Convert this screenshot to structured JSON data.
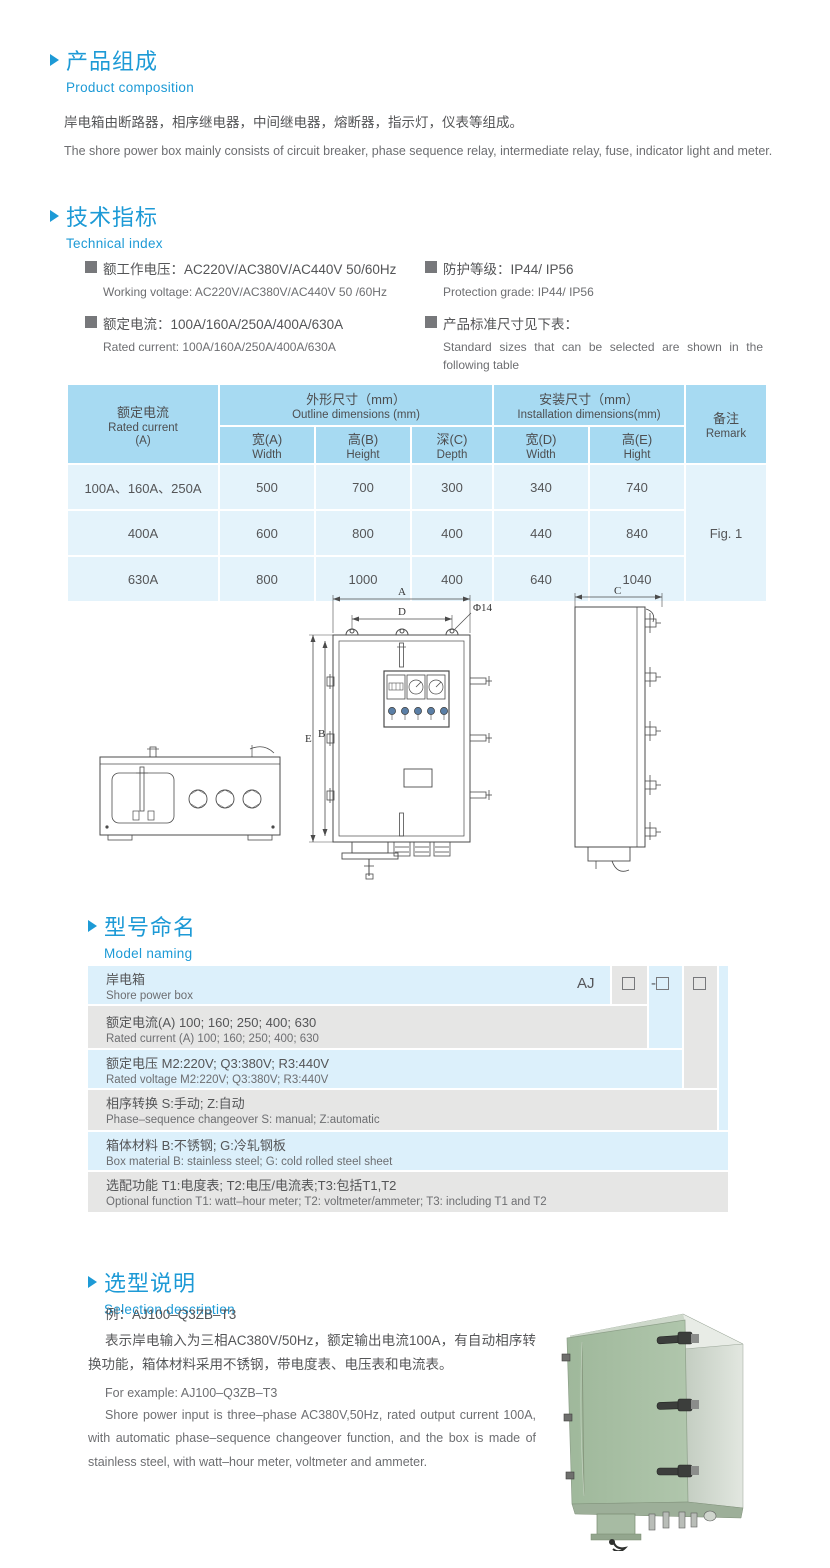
{
  "palette": {
    "accent_blue": "#1d9ad6",
    "table_header_blue": "#a7daf2",
    "table_cell_blue": "#e4f3fb",
    "naming_blue": "#dcf0fb",
    "naming_gray": "#e6e6e5",
    "photo_front_green": "#a9c0a5",
    "photo_side_gray": "#d6dcd4"
  },
  "section1": {
    "title_cn": "产品组成",
    "title_en": "Product  composition",
    "body_cn": "岸电箱由断路器，相序继电器，中间继电器，熔断器，指示灯，仪表等组成。",
    "body_en": "The shore power box mainly consists of circuit breaker, phase sequence relay, intermediate relay, fuse, indicator light and meter."
  },
  "section2": {
    "title_cn": "技术指标",
    "title_en": "Technical index",
    "specs": [
      {
        "cn": "额工作电压：AC220V/AC380V/AC440V  50/60Hz",
        "en": "Working voltage: AC220V/AC380V/AC440V 50 /60Hz"
      },
      {
        "cn": "额定电流：100A/160A/250A/400A/630A",
        "en": "Rated current: 100A/160A/250A/400A/630A"
      },
      {
        "cn": "防护等级：IP44/ IP56",
        "en": "Protection grade: IP44/ IP56"
      },
      {
        "cn": "产品标准尺寸见下表：",
        "en": "Standard sizes that can be selected are shown in the following table"
      }
    ]
  },
  "dim_table": {
    "col_current_cn": "额定电流",
    "col_current_en": "Rated current",
    "col_current_unit": "(A)",
    "outline_cn": "外形尺寸（mm）",
    "outline_en": "Outline dimensions (mm)",
    "install_cn": "安装尺寸（mm）",
    "install_en": "Installation dimensions(mm)",
    "remark_cn": "备注",
    "remark_en": "Remark",
    "sub_headers": [
      {
        "cn": "宽(A)",
        "en": "Width"
      },
      {
        "cn": "高(B)",
        "en": "Height"
      },
      {
        "cn": "深(C)",
        "en": "Depth"
      },
      {
        "cn": "宽(D)",
        "en": "Width"
      },
      {
        "cn": "高(E)",
        "en": "Hight"
      }
    ],
    "rows": [
      {
        "current": "100A、160A、250A",
        "a": "500",
        "b": "700",
        "c": "300",
        "d": "340",
        "e": "740"
      },
      {
        "current": "400A",
        "a": "600",
        "b": "800",
        "c": "400",
        "d": "440",
        "e": "840"
      },
      {
        "current": "630A",
        "a": "800",
        "b": "1000",
        "c": "400",
        "d": "640",
        "e": "1040"
      }
    ],
    "remark_value": "Fig. 1"
  },
  "drawing_labels": {
    "a": "A",
    "b": "B",
    "c": "C",
    "d": "D",
    "e": "E",
    "phi": "Φ14"
  },
  "section3": {
    "title_cn": "型号命名",
    "title_en": "Model naming",
    "code_prefix": "AJ",
    "code_dash": "-",
    "rows": [
      {
        "cn": "岸电箱",
        "en": "Shore power box"
      },
      {
        "cn": "额定电流(A)  100; 160; 250; 400; 630",
        "en": "Rated current (A) 100; 160; 250; 400; 630"
      },
      {
        "cn": "额定电压   M2:220V;  Q3:380V;  R3:440V",
        "en": "Rated voltage  M2:220V;  Q3:380V;  R3:440V"
      },
      {
        "cn": "相序转换  S:手动; Z:自动",
        "en": "Phase–sequence changeover  S: manual;  Z:automatic"
      },
      {
        "cn": "箱体材料    B:不锈钢;  G:冷轧钢板",
        "en": "Box material   B: stainless steel; G: cold rolled steel sheet"
      },
      {
        "cn": "选配功能     T1:电度表;  T2:电压/电流表;T3:包括T1,T2",
        "en": "Optional function  T1: watt–hour meter; T2: voltmeter/ammeter; T3: including T1 and T2"
      }
    ]
  },
  "section4": {
    "title_cn": "选型说明",
    "title_en": "Selection description",
    "example_cn": "例：AJ100–Q3ZB–T3",
    "body_cn": "表示岸电输入为三相AC380V/50Hz，额定输出电流100A，有自动相序转换功能，箱体材料采用不锈钢，带电度表、电压表和电流表。",
    "example_en": "For example: AJ100–Q3ZB–T3",
    "body_en": "Shore power input is three–phase AC380V,50Hz, rated output current 100A, with automatic phase–sequence changeover function, and the box is made of stainless steel, with watt–hour meter, voltmeter and ammeter."
  }
}
